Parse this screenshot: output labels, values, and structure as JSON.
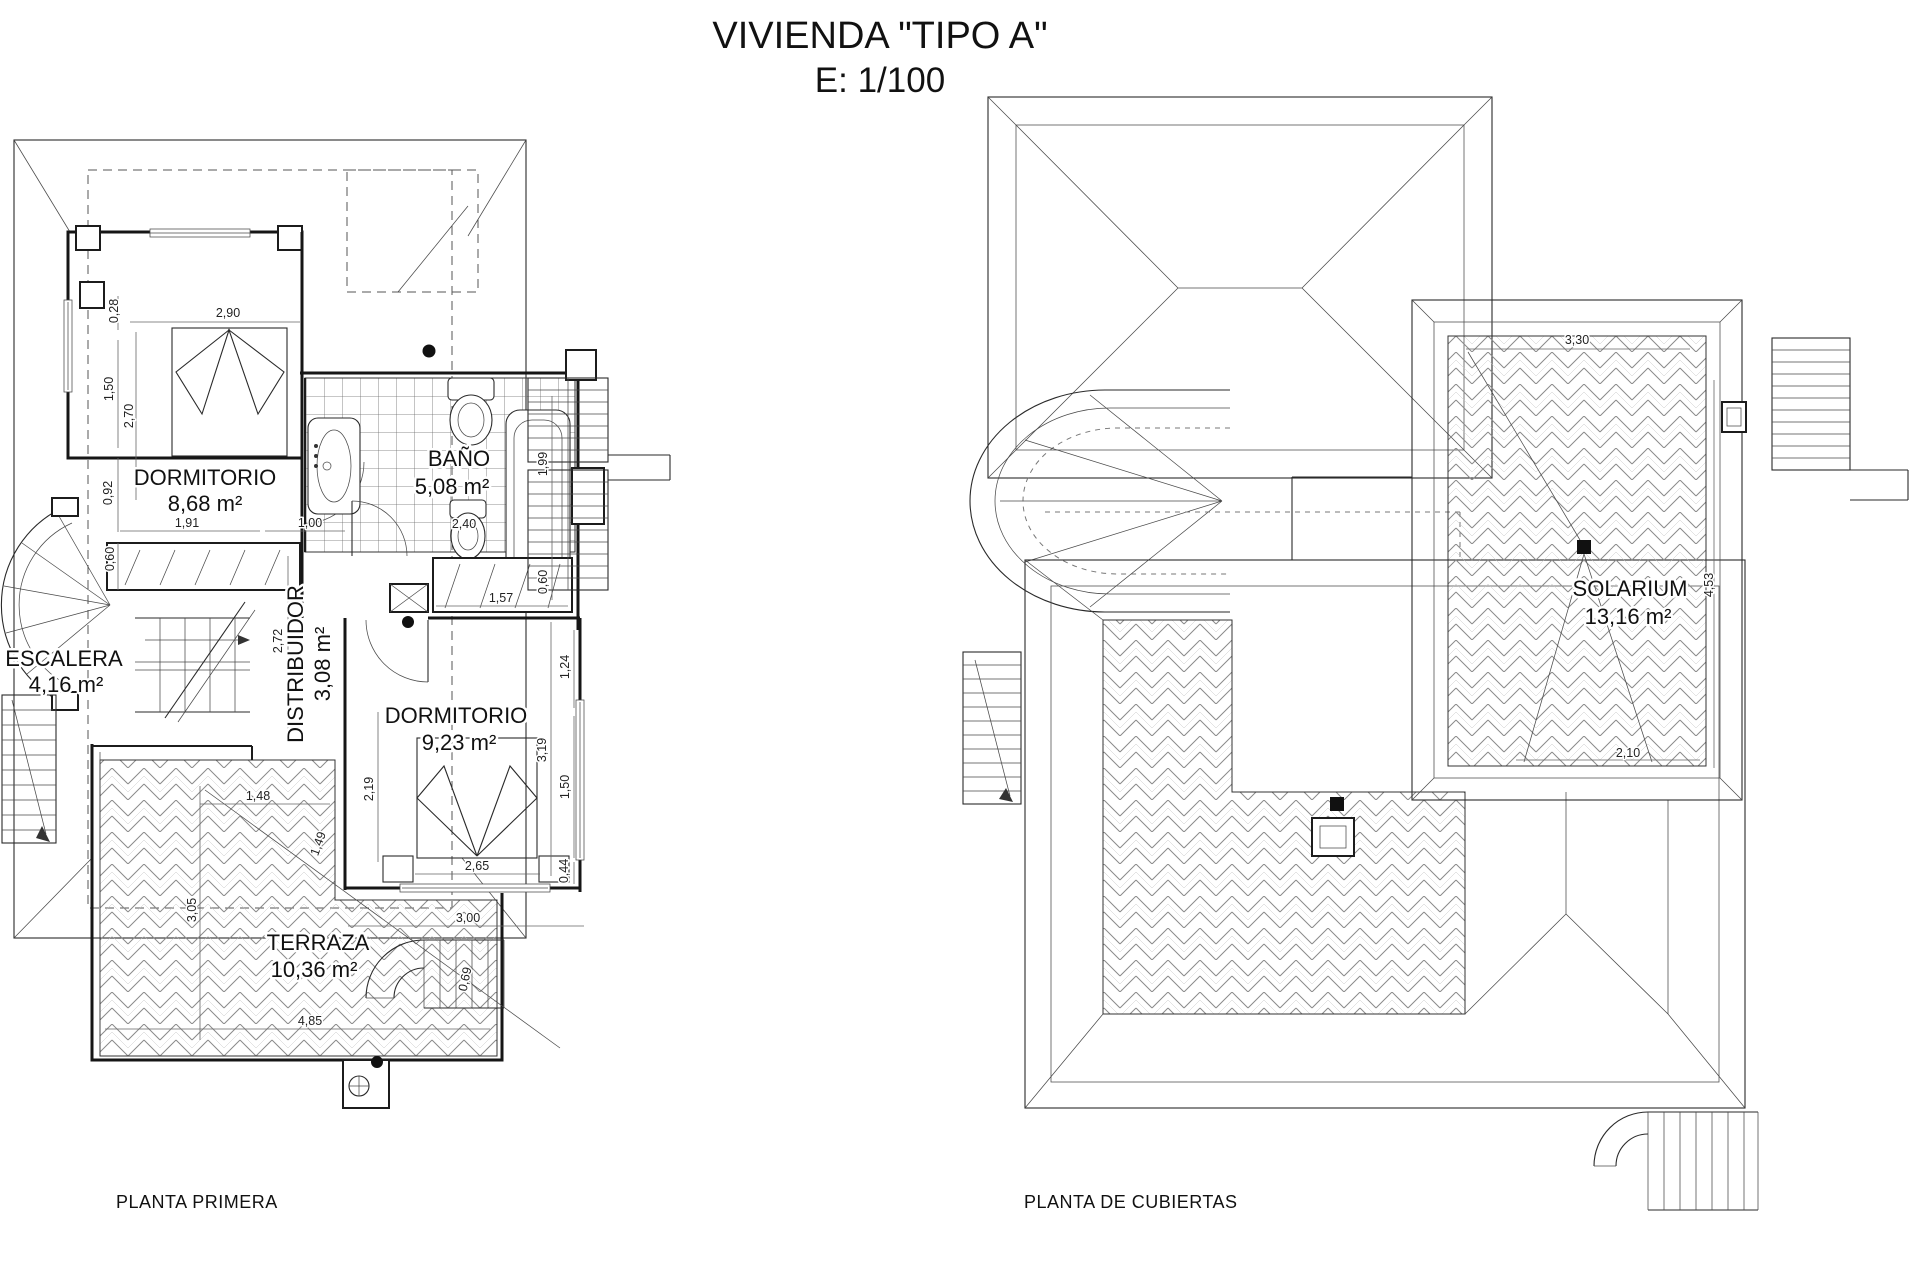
{
  "title": {
    "line1": "VIVIENDA \"TIPO A\"",
    "line2": "E: 1/100"
  },
  "colors": {
    "ink": "#1a1a1a",
    "background": "#ffffff"
  },
  "plans": [
    {
      "id": "planta-primera",
      "caption": "PLANTA PRIMERA",
      "rooms": [
        {
          "name": "DORMITORIO",
          "area": "8,68 m²",
          "x": 205,
          "y": 485,
          "ax": 205,
          "ay": 511
        },
        {
          "name": "BAÑO",
          "area": "5,08 m²",
          "x": 459,
          "y": 466,
          "ax": 452,
          "ay": 494
        },
        {
          "name": "ESCALERA",
          "area": "4,16 m²",
          "x": 64,
          "y": 666,
          "ax": 66,
          "ay": 692
        },
        {
          "name": "DISTRIBUIDOR",
          "area": "3,08 m²",
          "x": 303,
          "y": 664,
          "rot": -90,
          "ax": 330,
          "ay": 664,
          "arot": -90
        },
        {
          "name": "DORMITORIO",
          "area": "9,23 m²",
          "x": 456,
          "y": 723,
          "ax": 459,
          "ay": 750
        },
        {
          "name": "TERRAZA",
          "area": "10,36 m²",
          "x": 318,
          "y": 950,
          "ax": 314,
          "ay": 977
        }
      ],
      "dimensions": [
        {
          "t": "0,28",
          "x": 118,
          "y": 311,
          "rot": -90
        },
        {
          "t": "2,90",
          "x": 228,
          "y": 317
        },
        {
          "t": "1,50",
          "x": 113,
          "y": 389,
          "rot": -90
        },
        {
          "t": "2,70",
          "x": 133,
          "y": 416,
          "rot": -90
        },
        {
          "t": "0,92",
          "x": 112,
          "y": 493,
          "rot": -90
        },
        {
          "t": "1,91",
          "x": 187,
          "y": 527
        },
        {
          "t": "1,00",
          "x": 310,
          "y": 527
        },
        {
          "t": "0,60",
          "x": 114,
          "y": 559,
          "rot": -90
        },
        {
          "t": "2,72",
          "x": 282,
          "y": 641,
          "rot": -90
        },
        {
          "t": "2,40",
          "x": 464,
          "y": 528
        },
        {
          "t": "1,99",
          "x": 547,
          "y": 464,
          "rot": -90
        },
        {
          "t": "0,60",
          "x": 547,
          "y": 582,
          "rot": -90
        },
        {
          "t": "1,57",
          "x": 501,
          "y": 602
        },
        {
          "t": "1,24",
          "x": 569,
          "y": 667,
          "rot": -90
        },
        {
          "t": "3,19",
          "x": 546,
          "y": 750,
          "rot": -90
        },
        {
          "t": "1,50",
          "x": 569,
          "y": 787,
          "rot": -90
        },
        {
          "t": "2,19",
          "x": 373,
          "y": 789,
          "rot": -90
        },
        {
          "t": "2,65",
          "x": 477,
          "y": 870
        },
        {
          "t": "0,44",
          "x": 568,
          "y": 871,
          "rot": -90
        },
        {
          "t": "1,48",
          "x": 258,
          "y": 800
        },
        {
          "t": "1,49",
          "x": 322,
          "y": 845,
          "rot": -70
        },
        {
          "t": "3,05",
          "x": 196,
          "y": 910,
          "rot": -90
        },
        {
          "t": "3,00",
          "x": 468,
          "y": 922
        },
        {
          "t": "4,85",
          "x": 310,
          "y": 1025
        },
        {
          "t": "0,69",
          "x": 469,
          "y": 980,
          "rot": -78
        }
      ]
    },
    {
      "id": "planta-cubiertas",
      "caption": "PLANTA DE CUBIERTAS",
      "rooms": [
        {
          "name": "SOLARIUM",
          "area": "13,16 m²",
          "x": 1630,
          "y": 596,
          "ax": 1628,
          "ay": 624
        }
      ],
      "dimensions": [
        {
          "t": "3,30",
          "x": 1577,
          "y": 344
        },
        {
          "t": "4,53",
          "x": 1713,
          "y": 585,
          "rot": -90
        },
        {
          "t": "2,10",
          "x": 1628,
          "y": 757
        }
      ]
    }
  ]
}
